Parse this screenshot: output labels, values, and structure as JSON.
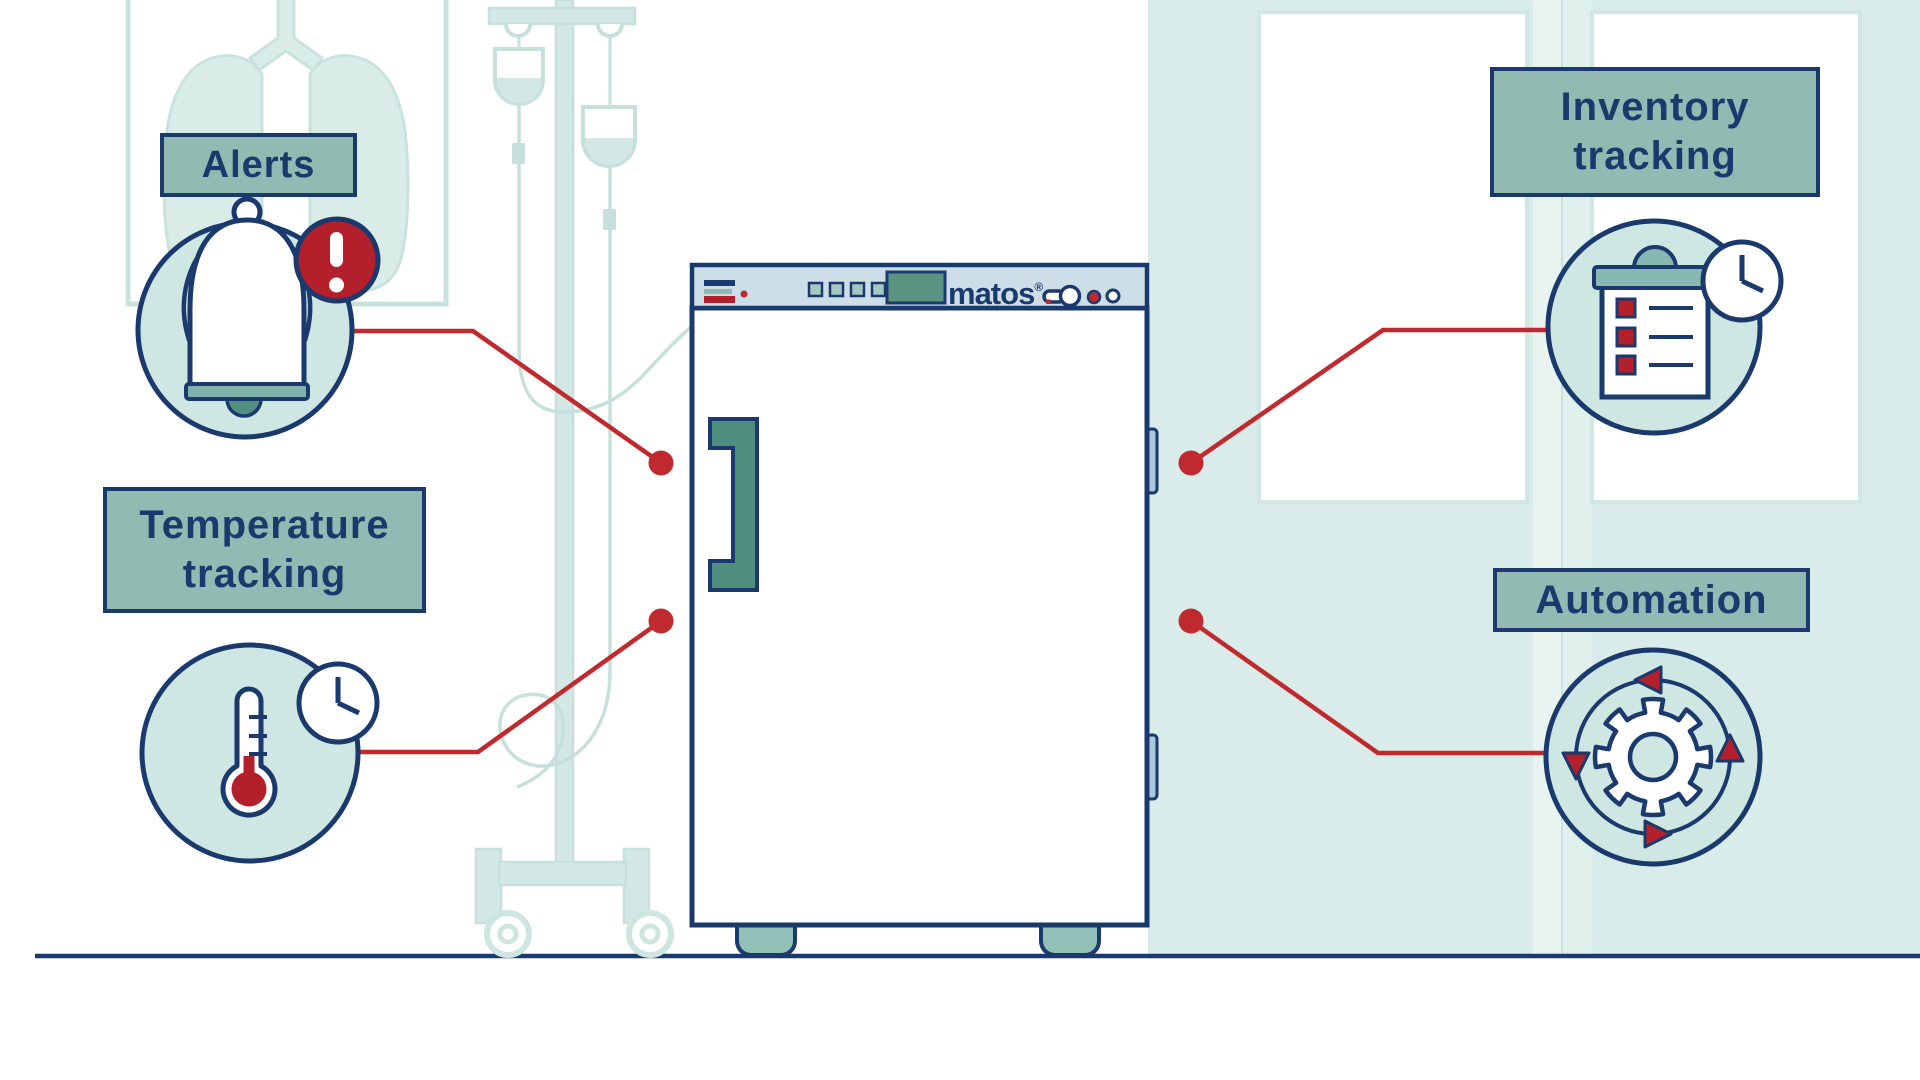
{
  "features": {
    "alerts": {
      "label": "Alerts"
    },
    "temperature": {
      "line1": "Temperature",
      "line2": "tracking"
    },
    "inventory": {
      "line1": "Inventory",
      "line2": "tracking"
    },
    "automation": {
      "label": "Automation"
    }
  },
  "device": {
    "brand": "matos",
    "brand_mark": "®",
    "brand_dot": "."
  },
  "icons": {
    "alerts": [
      "bell-icon",
      "alert-badge-icon"
    ],
    "temperature": [
      "thermometer-icon",
      "clock-icon"
    ],
    "inventory": [
      "clipboard-checklist-icon",
      "clock-icon"
    ],
    "automation": [
      "gear-icon",
      "cycle-arrows-icon"
    ],
    "device_panel": [
      "menu-bars-icon",
      "button-squares-icon",
      "display-icon",
      "keyhole-icon",
      "indicator-dots-icon"
    ]
  },
  "colors": {
    "navy": "#1a3a6e",
    "red_fill": "#b31f2b",
    "red_line": "#c02a2e",
    "label_teal": "#92bab2",
    "icon_circle_teal": "#cfe7e2",
    "background_teal": "#d9ece9",
    "fridge_panel_blue": "#cddee9",
    "hinge_blue": "#a9c9dc",
    "dark_green": "#4f8d7c",
    "medium_teal": "#8fbcb2",
    "pale_lineart_teal": "#c6e0db"
  }
}
